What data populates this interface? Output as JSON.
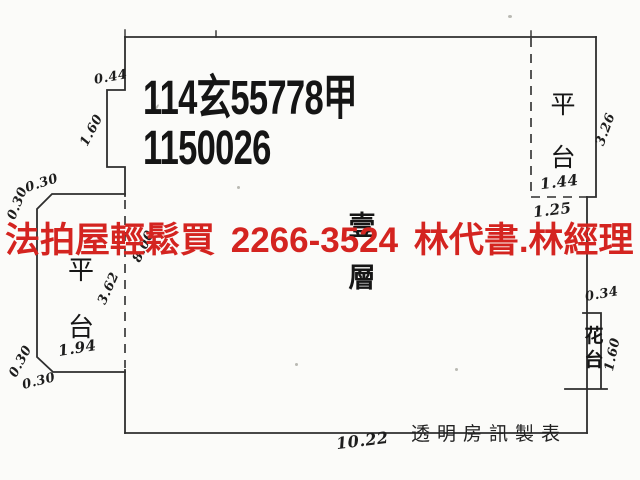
{
  "document": {
    "parcel_id_line1": "114玄55778甲",
    "parcel_id_line2": "1150026",
    "floor_label": "壹層",
    "credit_line": "透明房訊製表"
  },
  "watermark": {
    "text": "法拍屋輕鬆買 2266-3524 林代書.林經理",
    "phone": "2266-3524",
    "color": "#d42420"
  },
  "labels": {
    "left_platform": "平台",
    "right_platform": "平台",
    "flower_bed": "花台"
  },
  "dimensions": {
    "notch_width": "0.44",
    "notch_height": "1.60",
    "left_chamfer_top_a": "0.30",
    "left_chamfer_top_b": "0.30",
    "left_platform_height": "3.62",
    "left_platform_width": "1.94",
    "left_chamfer_bottom_a": "0.30",
    "left_chamfer_bottom_b": "0.30",
    "interior_depth": "8.00",
    "right_platform_height": "3.26",
    "right_platform_width": "1.44",
    "right_platform_offset": "1.25",
    "flower_bed_width": "0.34",
    "flower_bed_height": "1.60",
    "building_width": "10.22"
  },
  "colors": {
    "background": "#fbfbf9",
    "line": "#2e2e2e",
    "ink": "#1c1c1c"
  }
}
